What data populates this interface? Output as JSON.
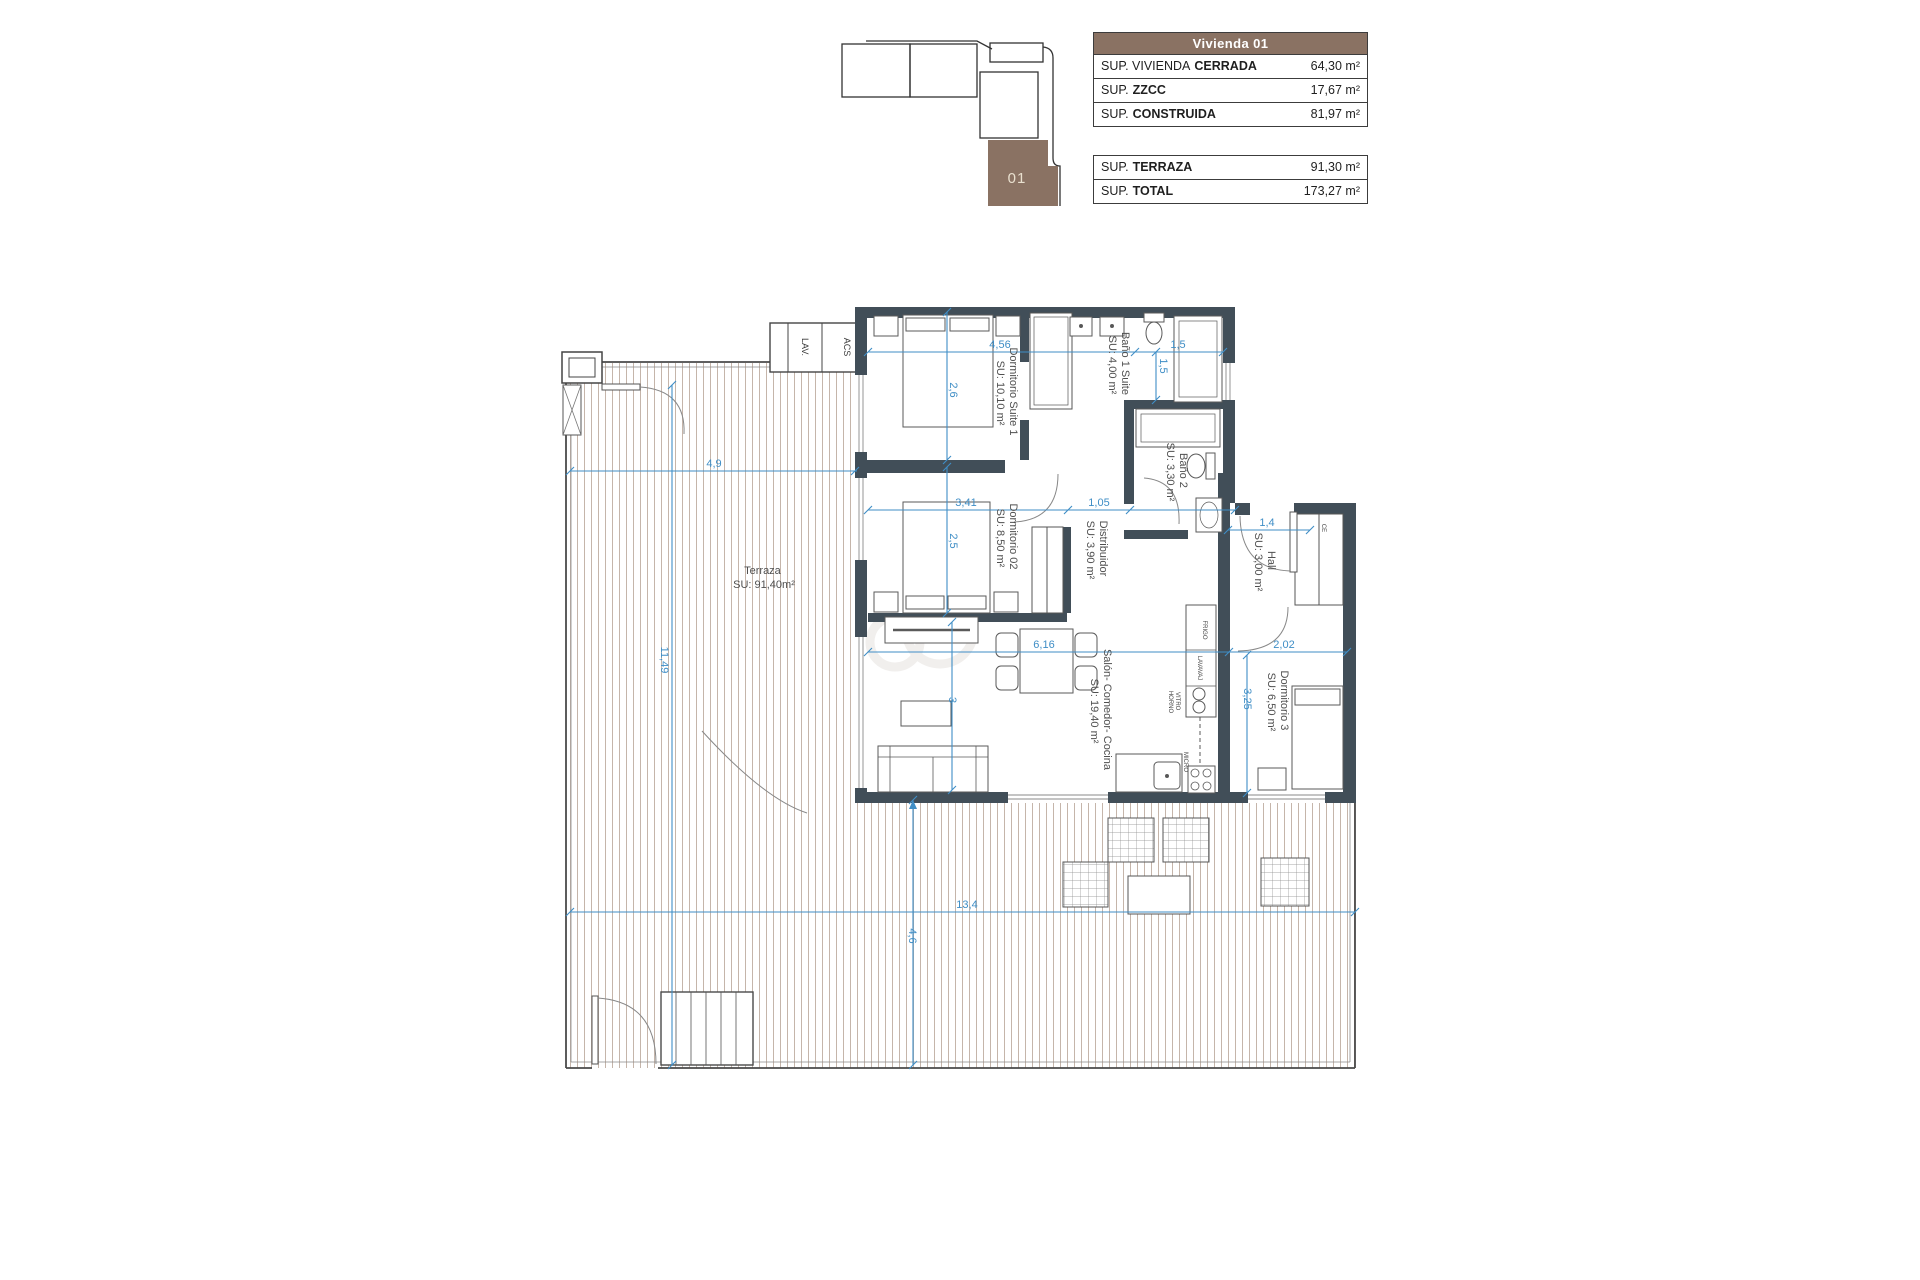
{
  "key_plan": {
    "unit_label": "01",
    "unit_color": "#8a7263"
  },
  "area_tables": {
    "header": "Vivienda 01",
    "header_bg": "#8a7263",
    "table1_rows": [
      {
        "label_regular": "SUP. VIVIENDA",
        "label_bold": "CERRADA",
        "value": "64,30 m²"
      },
      {
        "label_regular": "SUP.",
        "label_bold": "ZZCC",
        "value": "17,67 m²"
      },
      {
        "label_regular": "SUP.",
        "label_bold": "CONSTRUIDA",
        "value": "81,97 m²"
      }
    ],
    "table2_rows": [
      {
        "label_regular": "SUP.",
        "label_bold": "TERRAZA",
        "value": "91,30 m²"
      },
      {
        "label_regular": "SUP.",
        "label_bold": "TOTAL",
        "value": "173,27 m²"
      }
    ]
  },
  "floor_plan": {
    "rooms": [
      {
        "name": "Dormitorio Suite 1",
        "area": "SU: 10,10 m²"
      },
      {
        "name": "Baño 1 Suite",
        "area": "SU: 4,00 m²"
      },
      {
        "name": "Baño 2",
        "area": "SU: 3,30 m²"
      },
      {
        "name": "Dormitorio 02",
        "area": "SU: 8,50 m²"
      },
      {
        "name": "Distribuidor",
        "area": "SU: 3,90 m²"
      },
      {
        "name": "Hall",
        "area": "SU: 3,00 m²"
      },
      {
        "name": "Salón- Comedor- Cocina",
        "area": "SU: 19,40 m²"
      },
      {
        "name": "Dormitorio 3",
        "area": "SU: 6,50 m²"
      },
      {
        "name": "Terraza",
        "area": "SU: 91,40m²"
      }
    ],
    "closet_labels": {
      "lav": "LAV.",
      "acs": "ACS",
      "ce": "CE"
    },
    "kitchen_labels": {
      "frigo": "FRIGO",
      "lavavaj": "LAVAVAJ",
      "vitro": "VITRO",
      "horno": "HORNO",
      "micro": "MICRO"
    },
    "dimensions": {
      "suite_w": "4,56",
      "suite_h": "2,6",
      "bath1_w": "1,5",
      "bath1_h": "1,5",
      "terrace_top": "4,9",
      "dorm2_w": "3,41",
      "distr_w": "1,05",
      "dorm2_h": "2,5",
      "salon_w": "6,16",
      "hall_w": "2,02",
      "dorm3_h": "3,25",
      "hall_d": "1,4",
      "salon_h": "3",
      "terrace_left": "11,49",
      "terrace_bottom_h": "4,6",
      "terrace_bottom_w": "13,4"
    },
    "colors": {
      "wall": "#414e58",
      "dimension": "#3f8ec6",
      "hatch": "#b7a396"
    }
  }
}
